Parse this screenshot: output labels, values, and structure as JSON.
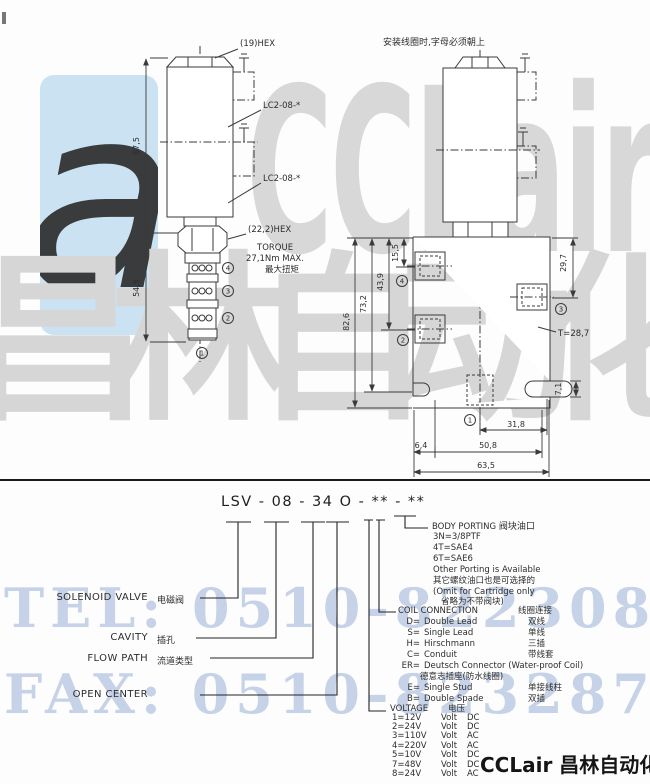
{
  "watermark": {
    "brand": "CCLair",
    "brand_cjk": "昌林自动化",
    "tel_line": "TEL: 0510-82230871",
    "fax_line": "FAX: 0510-82328771",
    "logo_glyph": "a",
    "accent_blue": "#cbe2f2",
    "gray": "#d8d8d8"
  },
  "footer": {
    "brand": "CCLair 昌林自动化"
  },
  "left_view": {
    "hex_top": "(19)HEX",
    "cavity_1": "LC2-08-*",
    "cavity_2": "LC2-08-*",
    "dim_coil_height": "87,5",
    "dim_cartridge_height": "54,5",
    "hex_bottom": "(22,2)HEX",
    "torque_1": "TORQUE",
    "torque_2": "27,1Nm MAX.",
    "torque_3": "最大扭矩",
    "port_4": "4",
    "port_3": "3",
    "port_2": "2",
    "port_1": "1"
  },
  "right_view": {
    "note": "安装线圈时,字母必须朝上",
    "dim_82_6": "82,6",
    "dim_73_2": "73,2",
    "dim_43_9": "43,9",
    "dim_15_5": "15,5",
    "dim_29_7": "29,7",
    "thread": "T=28,7",
    "dim_7_1": "7,1",
    "dim_31_8": "31,8",
    "dim_50_8": "50,8",
    "dim_63_5": "63,5",
    "dim_6_4": "6,4",
    "port_4": "4",
    "port_2": "2",
    "port_3": "3",
    "port_1": "1"
  },
  "model": {
    "code": "LSV - 08 - 34 O - ** - **",
    "labels": [
      {
        "en": "SOLENOID VALVE",
        "cn": "电磁阀"
      },
      {
        "en": "CAVITY",
        "cn": "插孔"
      },
      {
        "en": "FLOW PATH",
        "cn": "流道类型"
      },
      {
        "en": "OPEN CENTER",
        "cn": ""
      }
    ],
    "body_porting": {
      "title_en": "BODY PORTING",
      "title_cn": "阀块油口",
      "lines": [
        "3N=3/8PTF",
        "4T=SAE4",
        "6T=SAE6",
        "Other Porting is Available",
        "其它螺纹油口也是可选择的",
        "(Omit for Cartridge only",
        "省略为不带阀块)"
      ]
    },
    "coil_connection": {
      "title_en": "COIL CONNECTION",
      "title_cn": "线圈连接",
      "rows": [
        {
          "code": "D=",
          "en": "Double Lead",
          "cn": "双线"
        },
        {
          "code": "S=",
          "en": "Single Lead",
          "cn": "单线"
        },
        {
          "code": "H=",
          "en": "Hirschmann",
          "cn": "三插"
        },
        {
          "code": "C=",
          "en": "Conduit",
          "cn": "带线套"
        },
        {
          "code": "ER=",
          "en": "Deutsch Connector (Water-proof Coil)",
          "cn": ""
        },
        {
          "code": "",
          "en": "德意志插座(防水线圈)",
          "cn": ""
        },
        {
          "code": "E=",
          "en": "Single Stud",
          "cn": "单接线柱"
        },
        {
          "code": "B=",
          "en": "Double Spade",
          "cn": "双插"
        }
      ]
    },
    "voltage": {
      "title_en": "VOLTAGE",
      "title_cn": "电压",
      "rows": [
        {
          "code": "1=12V",
          "unit": "Volt",
          "type": "DC"
        },
        {
          "code": "2=24V",
          "unit": "Volt",
          "type": "DC"
        },
        {
          "code": "3=110V",
          "unit": "Volt",
          "type": "AC"
        },
        {
          "code": "4=220V",
          "unit": "Volt",
          "type": "AC"
        },
        {
          "code": "5=10V",
          "unit": "Volt",
          "type": "DC"
        },
        {
          "code": "7=48V",
          "unit": "Volt",
          "type": "DC"
        },
        {
          "code": "8=24V",
          "unit": "Volt",
          "type": "AC"
        }
      ]
    }
  }
}
